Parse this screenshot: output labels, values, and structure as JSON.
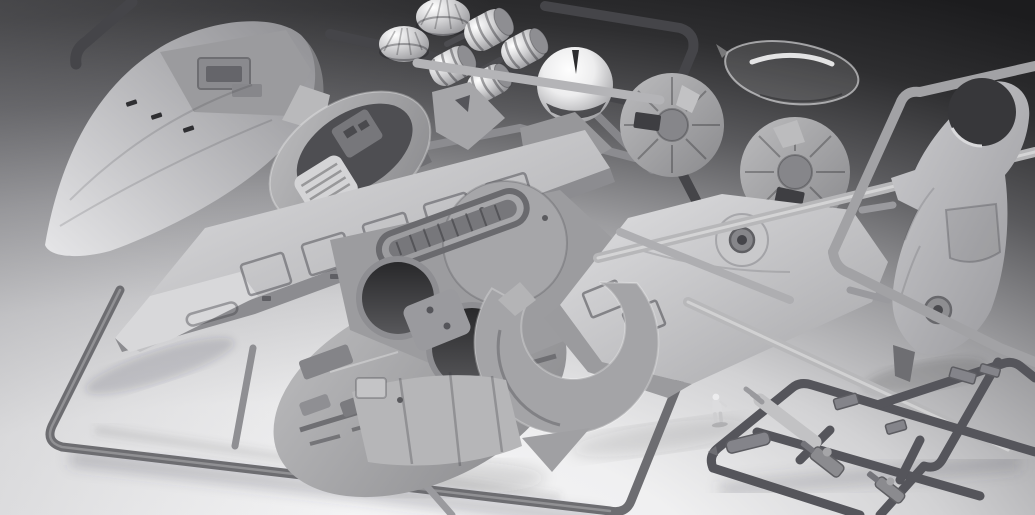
{
  "scene": {
    "subject": "Photograph of an unassembled gray plastic model kit: spacecraft parts on injection-molded sprues arranged on a studio backdrop that fades from dark gray at the top to white at the bottom",
    "media": "photo",
    "text_content": "none",
    "backdrop": {
      "top": "#1c1c1e",
      "middle": "#9b9b9e",
      "bottom": "#f8f8f9"
    },
    "plastic_palette": {
      "light_gray": "#d6d6d8",
      "mid_gray": "#a8a8ab",
      "dark_gray": "#6a6a6d",
      "sprue_dark": "#47474b",
      "runner_light": "#b8b8ba",
      "clear_part": "rgba(255,255,255,0.14)"
    },
    "parts": [
      {
        "name": "hull-cowl",
        "desc": "large smooth curved hull cowl with flat deck and raised bracket, upper left"
      },
      {
        "name": "dark-sprue-frame",
        "desc": "dark runner frame across the top holding domes and engine bells"
      },
      {
        "name": "ribbed-domes",
        "desc": "two ribbed lamp-shade domes on the top sprue"
      },
      {
        "name": "engine-bells",
        "desc": "four ribbed cylindrical engine bells on the top sprue"
      },
      {
        "name": "sensor-dome",
        "desc": "large smooth bright dome with notch and visor slot"
      },
      {
        "name": "clear-canopy",
        "desc": "transparent curved cockpit canopy, upper right, loose on backdrop"
      },
      {
        "name": "cockpit-tub",
        "desc": "oval cockpit tub with seat and floor grate, center left"
      },
      {
        "name": "bracket-parts",
        "desc": "angular bracket and strut parts around the cockpit"
      },
      {
        "name": "side-discs",
        "desc": "two circular side-pod discs with radial spokes and rectangular cutouts"
      },
      {
        "name": "wing-panel",
        "desc": "long paneled wing blade with rectangular hatches, lower left, on large open frame"
      },
      {
        "name": "hull-core",
        "desc": "central hull core with two round engine openings, slotted plate and greebled underside"
      },
      {
        "name": "body-half",
        "desc": "horizontal body shell half with conical boss, hatch frames and round engine cutout"
      },
      {
        "name": "crescent-ring",
        "desc": "C-shaped crescent ring part over the body half cutout"
      },
      {
        "name": "curved-shield",
        "desc": "curved rectangular shield panel with seams, bottom center"
      },
      {
        "name": "fuselage-half",
        "desc": "tall starboard fuselage half with round cockpit opening and landing-gear boss, right side frame"
      },
      {
        "name": "small-parts-sprue",
        "desc": "dark sprue of small parts bottom right: cannons, cylinders, brackets"
      },
      {
        "name": "pilot-figure",
        "desc": "tiny standing pilot figure beside the small-parts sprue"
      },
      {
        "name": "runners",
        "desc": "light gray cylindrical runners crossing the layout"
      },
      {
        "name": "floor-shadows",
        "desc": "soft shadows cast on the light lower backdrop"
      }
    ]
  }
}
